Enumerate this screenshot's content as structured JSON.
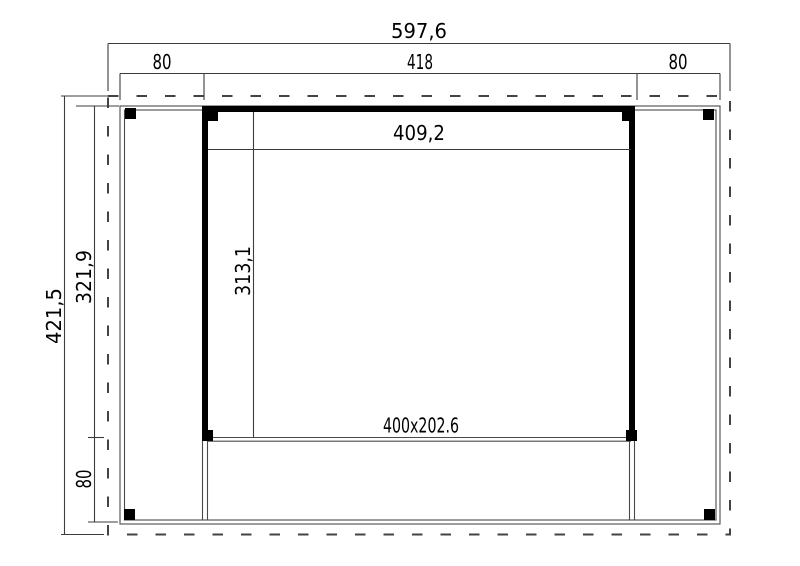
{
  "drawing": {
    "type": "floor-plan",
    "dims": {
      "overall_width": "597,6",
      "overhang_left": "80",
      "body_width": "418",
      "overhang_right": "80",
      "overall_depth": "421,5",
      "room_depth": "321,9",
      "deck_depth": "80",
      "inner_width": "409,2",
      "inner_depth": "313,1",
      "front_opening": "400x202.6"
    },
    "colors": {
      "wall": "#000000",
      "dimension_line": "#3c3c3c",
      "deck_line": "#4a4a4a",
      "roof_outline": "#434343",
      "background": "#ffffff"
    }
  }
}
